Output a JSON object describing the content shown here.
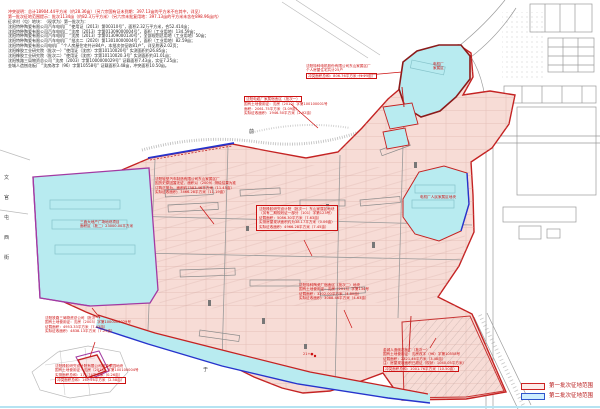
{
  "legend": {
    "items": [
      {
        "label": "第一批次征地范围"
      },
      {
        "label": "第二批次征地范围"
      }
    ]
  },
  "colors": {
    "batch1_outline": "#c42222",
    "batch1_fill": "#f7dcd6",
    "batch2_outline": "#2633cc",
    "batch2_fill": "#b8ebf0",
    "annotation_red": "#cc1111",
    "purple_boundary": "#a23aa2",
    "linework_gray": "#9a9a9a"
  },
  "title_block": {
    "lines": [
      {
        "text": "冲突说明：总计18904.44平方米（约28.36亩）（另六宗国有证未到期：397.13亩的平方米不在其中，详见）",
        "cls": "red"
      },
      {
        "text": "第一批次征地范围提示：批次1134亩（约82.3万平方米）（另六宗未批复用地：397.13亩的平方米未含在898.96亩内）",
        "cls": "red"
      },
      {
        "text": "征求村（屯）地块：（现状为）第一批次为：",
        "cls": "blk"
      },
      {
        "text": "沈阳特种陶瓷有限公司汽车电机厂 “使用证（2013）第00310号”，面积2.32万平方米，合52.414亩；",
        "cls": "blk"
      },
      {
        "text": "沈阳特种陶瓷有限公司汽车电机厂 “沈房（2013）字第01309000004号”，面积（工业用地）134.59亩；",
        "cls": "blk"
      },
      {
        "text": "沈阳特种陶瓷有限公司汽车电机厂 “沈房（2013）字第01309000130号”，全部规划总用地（工业用地）50亩；",
        "cls": "blk"
      },
      {
        "text": "沈阳特种陶瓷有限公司汽车电机厂 “批次二（2020）第13010000004号”，面积（工业用地）82.59亩；",
        "cls": "blk"
      },
      {
        "text": "沈阳特种陶瓷有限公司电机厂 “个人房屋住宅共计84户，本批次仅征收81户”，详见附表2.02页；",
        "cls": "blk"
      },
      {
        "text": "沈阳橡胶工业研究院（批次一）“使用证（沈房）字第10110020号” 实测面积约26.85亩；",
        "cls": "blk"
      },
      {
        "text": "沈阳橡胶工业研究院（批次二）“使用证（沈房）字第10110020.3号” 实测面积约31.01亩；",
        "cls": "blk"
      },
      {
        "text": "沈阳铁路三局物资总公司 “沈房（2003）字第1000000029号” 证载面积7.43亩，实征7.25亩；",
        "cls": "blk"
      },
      {
        "text": "金城人造刨花板厂 “沈房改字（96）字第10558号” 证载面积3.48亩，冲突面积10.50亩。",
        "cls": "blk"
      }
    ]
  },
  "annotations": {
    "east_housing": {
      "lines": [
        {
          "text": "沈阳特种电机股份有限公司东山家属区厂"
        },
        {
          "text": "个人房屋住宅共计25户"
        },
        {
          "text": "冲突面积总和：806.76平方米（1.21亩）",
          "cls": "boxed"
        }
      ]
    },
    "cable_plant": {
      "lines": [
        {
          "text": "沈阳电缆厂家属宿舍区（批次一）",
          "cls": "boxed"
        },
        {
          "text": "国有土地使用证：沈房（2010）字第100100001号"
        },
        {
          "text": "面积：2061.75平方米（3.09亩）"
        },
        {
          "text": "实际征收面积：1946.50平方米（2.92亩）"
        }
      ]
    },
    "light_vehicle": {
      "lines": [
        {
          "text": "沈阳轻型汽车制造有限公司东山家属区厂"
        },
        {
          "text": "因历史原因暂无证，面积以（2009）测绘结果为准"
        },
        {
          "text": "订购正常为，面积约7583.46平方米（11.45亩）"
        },
        {
          "text": "实际征收面积：7466.28平方米（11.19亩）"
        }
      ]
    },
    "rubber_institute": {
      "lines": [
        {
          "text": "沈阳橡胶研究设计院（批次一）东山家属区地块"
        },
        {
          "text": "（另有二期规划证一部分（101）字第123号）"
        },
        {
          "text": "证载面积：5086.30平方米（7.63亩）"
        },
        {
          "text": "实测房屋现状面积约为38.17平方米（0.06亩）"
        },
        {
          "text": "实际征收面积：4966.28平方米（7.45亩）"
        }
      ]
    },
    "ceramics_dorm": {
      "lines": [
        {
          "text": "沈阳特种陶瓷厂宿舍区（批次二）地块"
        },
        {
          "text": "国有土地使用证：沈房（2013）字第134号"
        },
        {
          "text": "证载面积：3202.00平方米（4.80亩）"
        },
        {
          "text": "实际征收面积：3088.46平方米（4.63亩）"
        }
      ]
    },
    "particle_board": {
      "lines": [
        {
          "text": "金城人造刨花板厂（批次一）"
        },
        {
          "text": "国有土地使用证：沈房改字（96）字第10558号"
        },
        {
          "text": "证载面积：2321.46平方米（3.48亩）"
        },
        {
          "text": "注：房屋现状面积已超证（现状：1040.05平方米）"
        },
        {
          "text": "冲突面积总和：1001.76平方米（10.50亩）",
          "cls": "boxed"
        }
      ]
    },
    "railway_bureau": {
      "lines": [
        {
          "text": "沈阳铁路三局物资总公司（批次一）"
        },
        {
          "text": "国有土地使用证：沈房（2003）字第1000000029号"
        },
        {
          "text": "证载面积：4953.33平方米（7.43亩）"
        },
        {
          "text": "实际征收面积：4838.13平方米（7.25亩）"
        }
      ]
    },
    "rubber_design": {
      "lines": [
        {
          "text": "沈阳橡胶研究设计院有限公司檀香家园地块"
        },
        {
          "text": "国有土地使用证：沈房（2013）字第100100004号"
        },
        {
          "text": "实测面积总和：171.74平方米（0.26亩）"
        },
        {
          "text": "冲突面积总和：167.56平方米（2.58亩）",
          "cls": "boxed"
        }
      ]
    },
    "plaza_block": {
      "lines": [
        {
          "text": "三鑫大地产广场地块项目"
        },
        {
          "text": "面积区（批二）23000.00平方米"
        }
      ]
    },
    "north_block": {
      "lines": [
        {
          "text": "电机厂"
        },
        {
          "text": "家属区"
        }
      ]
    },
    "committee_block": {
      "lines": [
        {
          "text": "电机厂人民家属区地块"
        }
      ]
    },
    "point_label": {
      "text": "21+●"
    }
  },
  "map_labels": {
    "left_street": [
      "文",
      "官",
      "屯",
      "西",
      "街"
    ],
    "char_top": "前",
    "char_bottom": "于"
  }
}
